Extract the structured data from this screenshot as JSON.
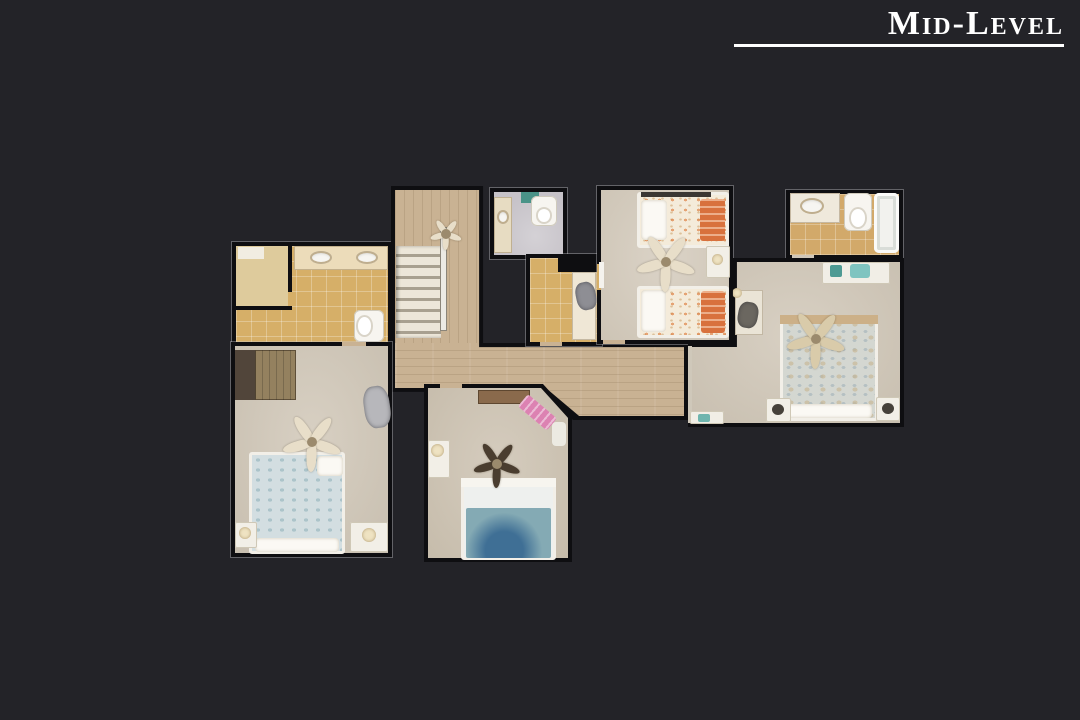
{
  "header": {
    "title": "Mid-Level"
  },
  "theme": {
    "background": "#232328",
    "title_color": "#ffffff",
    "underline_color": "#ffffff",
    "wall": "#0e0e11",
    "wood": "#c9b293",
    "tile": "#d6af68",
    "carpet": "#d1c8ba",
    "bath_floor": "#c6c2c8",
    "accent_orange": "#d8713d",
    "accent_teal": "#84aab4",
    "accent_pink": "#dc82b2",
    "duvet_blue": "#d3dee1",
    "fixture_white": "#f4f2ed"
  }
}
